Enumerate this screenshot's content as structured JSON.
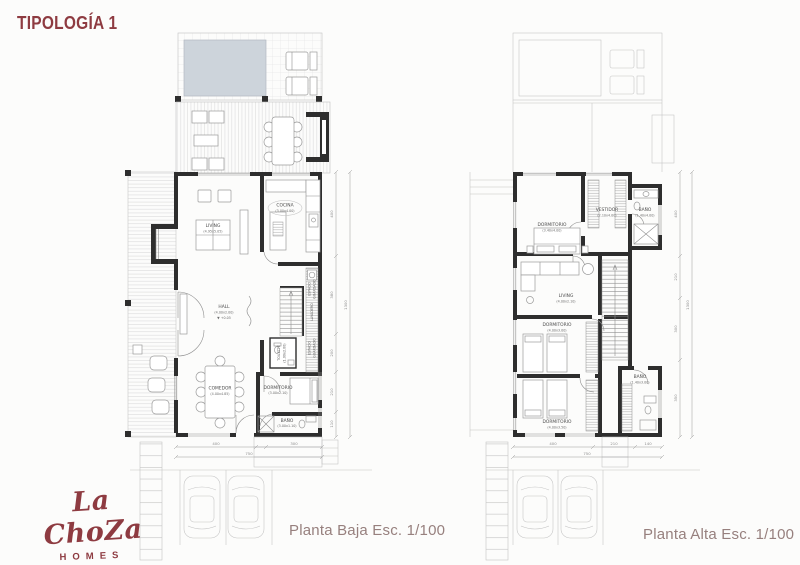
{
  "title": "TIPOLOGÍA 1",
  "logo": {
    "name": "La ChoZa",
    "subtitle": "HOMES"
  },
  "colors": {
    "accent": "#8E3B41",
    "caption_text": "#97807E",
    "wall": "#2E2E2E",
    "pool": "#CDD4DB"
  },
  "planta_baja": {
    "caption": "Planta Baja Esc. 1/100",
    "rooms": [
      {
        "name": "LIVING",
        "dims": "(4.95x5.05)"
      },
      {
        "name": "COCINA",
        "dims": "(3.00x4.00)"
      },
      {
        "name": "HALL",
        "dims": "(4.00x2.00)",
        "level": "▼ +0.05"
      },
      {
        "name": "COMEDOR",
        "dims": "(4.00x4.85)"
      },
      {
        "name": "DORMITORIO",
        "dims": "(3.00x2.10)"
      },
      {
        "name": "BAÑO",
        "dims": "(3.00x1.10)"
      },
      {
        "name": "TOILETTE",
        "dims": "(1.00x2.00)"
      },
      {
        "name": "LAVADERO"
      },
      {
        "name": "ESPACIO",
        "name2": "GUARDADO"
      },
      {
        "name": "ESPACIO",
        "name2": "GUARDADO"
      }
    ],
    "dims_right": [
      "400",
      "380",
      "200",
      "210",
      "110"
    ],
    "dims_right_total": "1300",
    "dims_bottom": [
      "400",
      "300"
    ],
    "dims_bottom_total": "750"
  },
  "planta_alta": {
    "caption": "Planta Alta Esc. 1/100",
    "rooms": [
      {
        "name": "DORMITORIO",
        "dims": "(3.40x4.00)"
      },
      {
        "name": "VESTIDOR",
        "dims": "(2.10x4.00)"
      },
      {
        "name": "BAÑO",
        "dims": "(1.40x4.00)"
      },
      {
        "name": "LIVING",
        "dims": "(4.00x2.10)"
      },
      {
        "name": "DORMITORIO",
        "dims": "(4.00x3.00)"
      },
      {
        "name": "DORMITORIO",
        "dims": "(4.00x3.50)"
      },
      {
        "name": "BAÑO",
        "dims": "(1.40x3.00)"
      }
    ],
    "dims_right": [
      "400",
      "210",
      "300",
      "350"
    ],
    "dims_right_total": "1300",
    "dims_bottom": [
      "400",
      "210",
      "140"
    ],
    "dims_bottom_total": "750"
  }
}
